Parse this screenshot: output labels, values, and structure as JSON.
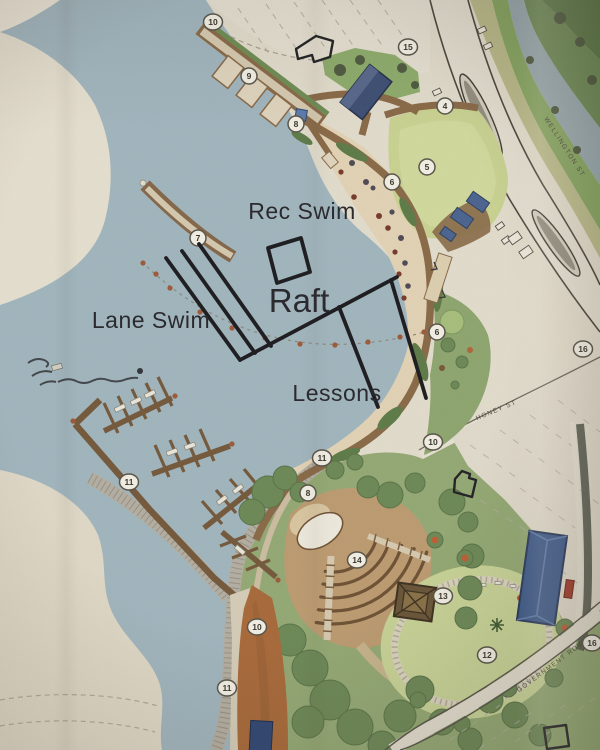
{
  "title": "Waterfront park site plan with swim area markup",
  "annotations": {
    "rec_swim": "Rec Swim",
    "raft": "Raft",
    "lane_swim": "Lane Swim",
    "lessons": "Lessons"
  },
  "streets": {
    "wellington": "WELLINGTON ST",
    "honey": "HONEY ST",
    "government": "GOVERNMENT ROW"
  },
  "markers": [
    {
      "label": "10",
      "x": 213,
      "y": 22
    },
    {
      "label": "9",
      "x": 249,
      "y": 76
    },
    {
      "label": "8",
      "x": 296,
      "y": 124
    },
    {
      "label": "15",
      "x": 408,
      "y": 47
    },
    {
      "label": "4",
      "x": 445,
      "y": 106
    },
    {
      "label": "5",
      "x": 427,
      "y": 167
    },
    {
      "label": "6",
      "x": 392,
      "y": 182
    },
    {
      "label": "7",
      "x": 198,
      "y": 238
    },
    {
      "label": "6",
      "x": 437,
      "y": 332
    },
    {
      "label": "16",
      "x": 583,
      "y": 349
    },
    {
      "label": "10",
      "x": 433,
      "y": 442
    },
    {
      "label": "11",
      "x": 322,
      "y": 458
    },
    {
      "label": "8",
      "x": 308,
      "y": 493
    },
    {
      "label": "11",
      "x": 129,
      "y": 482
    },
    {
      "label": "14",
      "x": 357,
      "y": 560
    },
    {
      "label": "13",
      "x": 443,
      "y": 596
    },
    {
      "label": "12",
      "x": 487,
      "y": 655
    },
    {
      "label": "10",
      "x": 257,
      "y": 627
    },
    {
      "label": "11",
      "x": 227,
      "y": 688
    },
    {
      "label": "16",
      "x": 592,
      "y": 643
    }
  ],
  "colors": {
    "water": "#a3b8c2",
    "paper": "#e6dfd0",
    "sand": "#e6d6b9",
    "lawn": "#ccd694",
    "park_green": "#95ab76",
    "tree_green": "#6d8a58",
    "dock_brown": "#85674a",
    "path_orange": "#aa6a3a",
    "building_blue": "#3d5a8c",
    "ink": "#1a1a1f"
  }
}
